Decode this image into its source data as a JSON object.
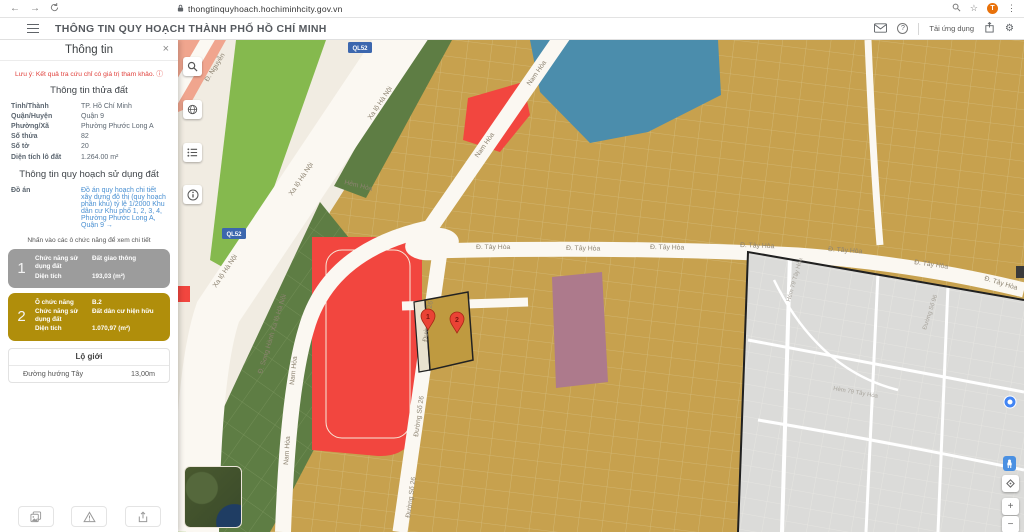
{
  "browser": {
    "url": "thongtinquyhoach.hochiminhcity.gov.vn",
    "profile_initial": "T"
  },
  "icons": {
    "back": "←",
    "forward": "→",
    "star": "☆",
    "kebab": "⋮",
    "gear": "⚙",
    "help": "?",
    "plus": "+",
    "minus": "−",
    "warning_info": "ⓘ",
    "link_arrow": "→",
    "close": "×"
  },
  "header": {
    "title": "THÔNG TIN QUY HOẠCH THÀNH PHỐ HỒ CHÍ MINH",
    "download_app": "Tải ứng dụng"
  },
  "sidebar": {
    "title": "Thông tin",
    "warning": "Lưu ý: Kết quả tra cứu chỉ có giá trị tham khảo.",
    "parcel_section_title": "Thông tin thửa đất",
    "parcel_fields": [
      {
        "label": "Tỉnh/Thành",
        "value": "TP. Hồ Chí Minh"
      },
      {
        "label": "Quận/Huyện",
        "value": "Quận 9"
      },
      {
        "label": "Phường/Xã",
        "value": "Phường Phước Long A"
      },
      {
        "label": "Số thửa",
        "value": "82"
      },
      {
        "label": "Số tờ",
        "value": "20"
      },
      {
        "label": "Diện tích lô đất",
        "value": "1.264.00 m²"
      }
    ],
    "planning_section_title": "Thông tin quy hoạch sử dụng đất",
    "do_an_label": "Đồ án",
    "do_an_link": "Đồ án quy hoạch chi tiết xây dựng đô thị (quy hoạch phân khu) tỷ lệ 1/2000 Khu dân cư Khu phố 1, 2, 3, 4, Phường Phước Long A, Quận 9",
    "hint": "Nhấn vào các ô chức năng để xem chi tiết",
    "zone1": {
      "number": "1",
      "fields": [
        {
          "label": "Chức năng sử dụng đất",
          "value": "Đất giao thông"
        },
        {
          "label": "Diện tích",
          "value": "193,03 (m²)"
        }
      ]
    },
    "zone2": {
      "number": "2",
      "fields": [
        {
          "label": "Ô chức năng",
          "value": "B.2"
        },
        {
          "label": "Chức năng sử dụng đất",
          "value": "Đất dân cư hiện hữu"
        },
        {
          "label": "Diện tích",
          "value": "1.070,97 (m²)"
        }
      ]
    },
    "lo_gioi": {
      "header": "Lộ giới",
      "row": {
        "name": "Đường hướng Tây",
        "value": "13,00m"
      }
    }
  },
  "map": {
    "labels": {
      "xa_lo_ha_noi": "Xa lộ Hà Nội",
      "ql52": "QL52",
      "nam_hoa": "Nam Hòa",
      "d_nguyen": "Đ. Nguyễn",
      "tay_hoa": "Đ. Tây Hòa",
      "duong_so_26": "Đường Số 26",
      "song_hanh": "Đ. Song Hành Xa lộ Hà Nội",
      "hem_hoa": "Hẻm Hòa",
      "hem_79": "Hẻm 79 Tây Hòa",
      "duong_so_96": "Đường Số 96",
      "pin1": "1",
      "pin2": "2"
    },
    "colors": {
      "residential_yellow": "#c7a14e",
      "traffic_red": "#f2463f",
      "green_space": "#5e7d44",
      "park_green": "#85b94e",
      "public_blue": "#4b8dac",
      "mixed_mauve": "#ad7a8c",
      "no_data_gray": "#dbdbd9",
      "selected_outline": "#222222",
      "zone1_gray": "#9c9c9c",
      "zone2_gold": "#b08e0b",
      "highway_badge_blue": "#3c67ae"
    }
  }
}
